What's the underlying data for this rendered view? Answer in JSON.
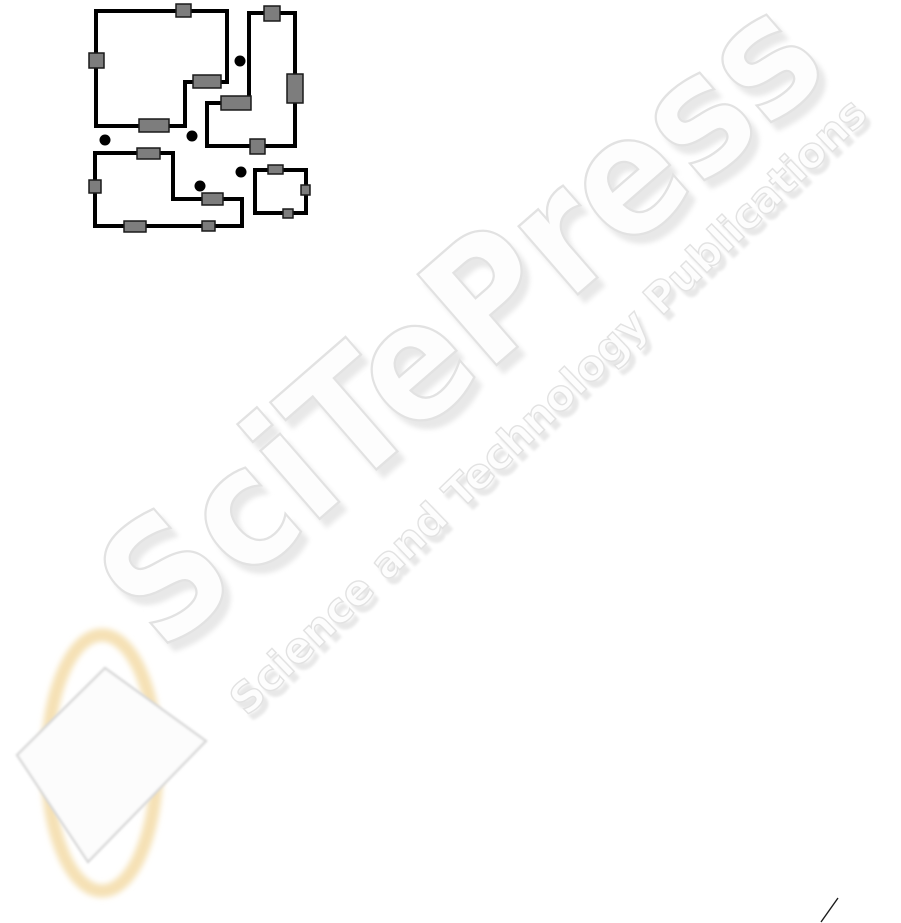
{
  "page": {
    "width": 901,
    "height": 923,
    "background": "#ffffff"
  },
  "colors": {
    "page_bg": "#ffffff",
    "wall": "#000000",
    "door_fill": "#7d7d7d",
    "door_stroke": "#1a1a1a",
    "dot": "#000000",
    "wm_fill": "#fdfdfd",
    "wm_outline": "#e2e2e2",
    "wm_shadow": "#e8e8e8",
    "logo_ring": "#f5e1b5",
    "diamond_fill": "#fcfcfc",
    "diamond_edge": "#d8d8d8",
    "slash": "#1a1a1a"
  },
  "watermark": {
    "title": "SciTePress",
    "subtitle": "Science and Technology Publications"
  },
  "figure": {
    "type": "floor-plan-diagram",
    "wall_width": 4,
    "rooms": [
      {
        "points": "96,11 227,11 227,82 185,82 185,126 96,126"
      },
      {
        "points": "249,13 295,13 295,146 207,146 207,103 249,103"
      },
      {
        "points": "95,153 173,153 173,199 242,199 242,226 95,226"
      },
      {
        "points": "255,170 306,170 306,213 255,213"
      }
    ],
    "doors": [
      {
        "x": 176,
        "y": 4,
        "w": 15,
        "h": 13
      },
      {
        "x": 89,
        "y": 53,
        "w": 15,
        "h": 15
      },
      {
        "x": 193,
        "y": 75,
        "w": 28,
        "h": 13
      },
      {
        "x": 139,
        "y": 119,
        "w": 30,
        "h": 13
      },
      {
        "x": 264,
        "y": 6,
        "w": 16,
        "h": 15
      },
      {
        "x": 287,
        "y": 74,
        "w": 16,
        "h": 29
      },
      {
        "x": 221,
        "y": 96,
        "w": 30,
        "h": 14
      },
      {
        "x": 250,
        "y": 139,
        "w": 15,
        "h": 15
      },
      {
        "x": 137,
        "y": 148,
        "w": 23,
        "h": 11
      },
      {
        "x": 89,
        "y": 180,
        "w": 12,
        "h": 13
      },
      {
        "x": 202,
        "y": 193,
        "w": 21,
        "h": 12
      },
      {
        "x": 124,
        "y": 221,
        "w": 22,
        "h": 11
      },
      {
        "x": 202,
        "y": 221,
        "w": 13,
        "h": 10
      },
      {
        "x": 268,
        "y": 165,
        "w": 15,
        "h": 9
      },
      {
        "x": 301,
        "y": 185,
        "w": 9,
        "h": 10
      },
      {
        "x": 283,
        "y": 209,
        "w": 10,
        "h": 9
      }
    ],
    "dots": [
      {
        "cx": 240,
        "cy": 61,
        "r": 5.5
      },
      {
        "cx": 105,
        "cy": 140,
        "r": 5.5
      },
      {
        "cx": 192,
        "cy": 136,
        "r": 5.5
      },
      {
        "cx": 241,
        "cy": 172,
        "r": 5.5
      },
      {
        "cx": 200,
        "cy": 186,
        "r": 5.5
      }
    ]
  },
  "logo": {
    "ellipse": {
      "cx": 102,
      "cy": 763,
      "rx": 55,
      "ry": 128
    },
    "diamond_points": "105,668 206,741 88,862 17,755"
  },
  "stray_mark": {
    "x1": 821,
    "y1": 922,
    "x2": 838,
    "y2": 898
  }
}
